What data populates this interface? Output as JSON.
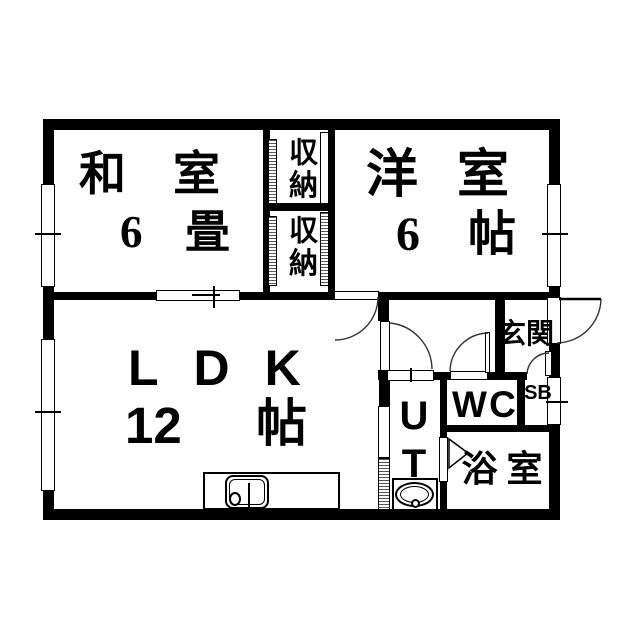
{
  "plan_title": "apartment-floor-plan",
  "colors": {
    "wall": "#000000",
    "background": "#ffffff",
    "line": "#000000"
  },
  "rooms": {
    "washitsu": {
      "name": "和室",
      "size_num": "6",
      "size_unit": "畳"
    },
    "closet_upper": {
      "name": "収納"
    },
    "closet_lower": {
      "name": "収納"
    },
    "yoshitsu": {
      "name": "洋室",
      "size_num": "6",
      "size_unit": "帖"
    },
    "ldk": {
      "name": "LDK",
      "size_num": "12",
      "size_unit": "帖"
    },
    "ut": {
      "name": "UT"
    },
    "wc": {
      "name": "WC"
    },
    "shoe_box": {
      "name": "SB"
    },
    "bath": {
      "name": "浴室"
    },
    "entrance": {
      "name": "玄関"
    }
  }
}
